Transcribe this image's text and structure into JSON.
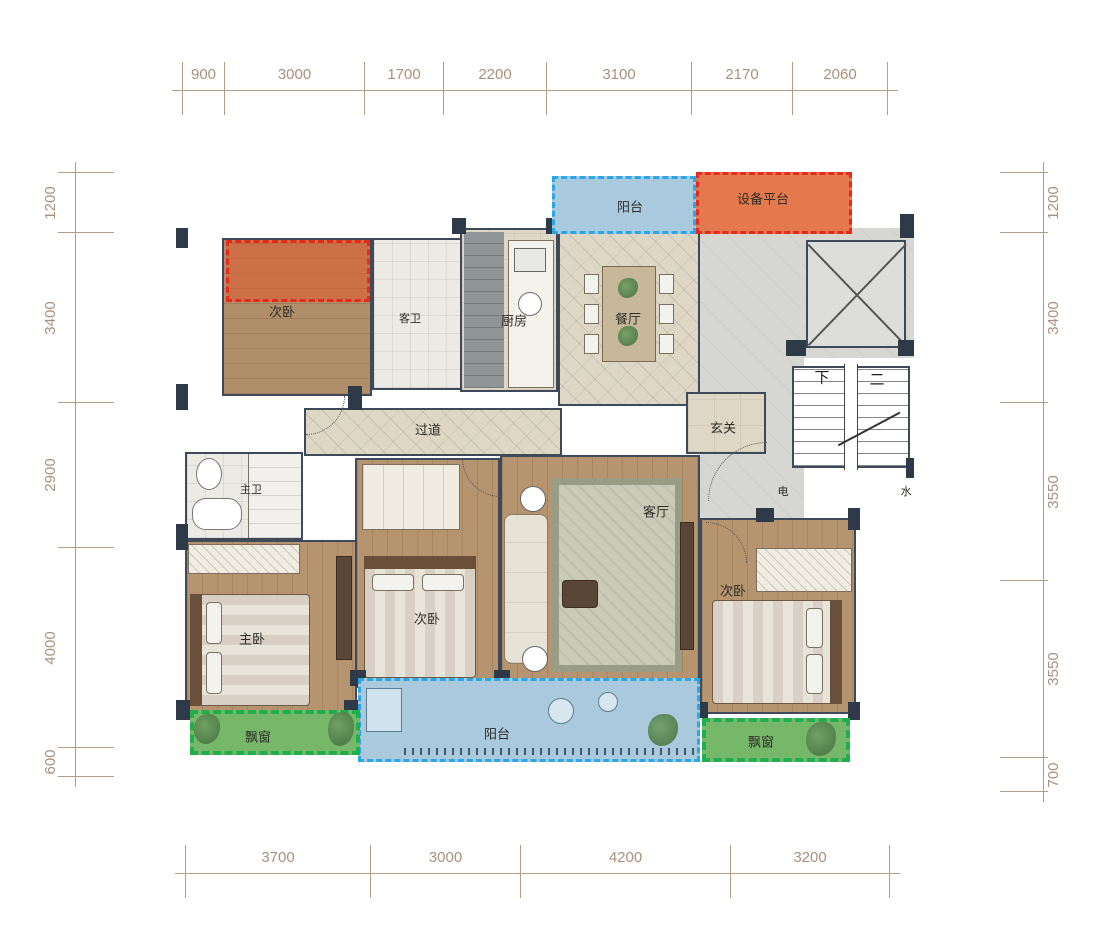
{
  "drawing": {
    "type": "apartment floor plan"
  },
  "dimensions": {
    "top": [
      "900",
      "3000",
      "1700",
      "2200",
      "3100",
      "2170",
      "2060"
    ],
    "bottom": [
      "3700",
      "3000",
      "4200",
      "3200"
    ],
    "left": [
      "1200",
      "3400",
      "2900",
      "4000",
      "600"
    ],
    "right": [
      "1200",
      "3400",
      "3550",
      "3550",
      "700"
    ]
  },
  "labels": {
    "bedroom_top_left": "次卧",
    "guest_bath": "客卫",
    "kitchen": "厨房",
    "dining": "餐厅",
    "balcony_top": "阳台",
    "equipment_platform": "设备平台",
    "hallway": "过道",
    "foyer": "玄关",
    "master_bath": "主卫",
    "living_room": "客厅",
    "master_bedroom": "主卧",
    "bedroom_middle": "次卧",
    "bedroom_right": "次卧",
    "bay_window_left": "飘窗",
    "balcony_bottom": "阳台",
    "bay_window_right": "飘窗",
    "stairs_down": "下",
    "stairs_up": "二",
    "shaft_electric": "电",
    "shaft_water": "水"
  },
  "colors": {
    "dimension_line": "#b49c85",
    "dimension_text": "#a8917c",
    "wall": "#3e4a5a",
    "wood_floor": "#b5946f",
    "tile_beige": "#ded7c6",
    "tile_gray": "#d6d6d3",
    "balcony_fill": "#a9c9de",
    "balcony_dash": "#2aa7e8",
    "platform_fill": "#e4794e",
    "platform_dash": "#e62b1e",
    "bay_fill": "#76b769",
    "bay_dash": "#1faf4e"
  }
}
